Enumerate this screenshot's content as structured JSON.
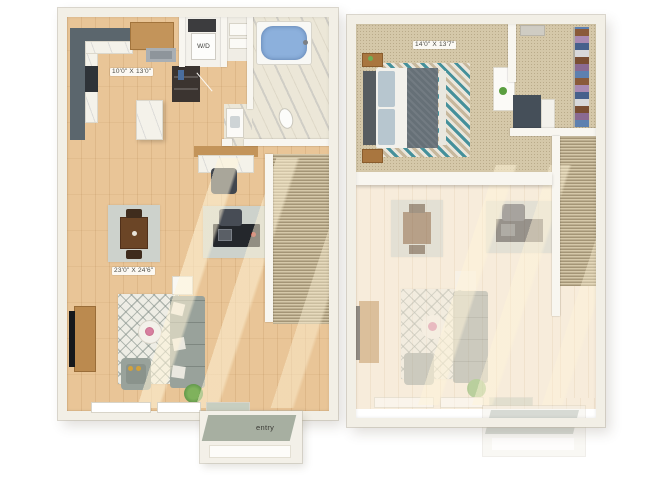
{
  "labels": {
    "floor1_kitchen_dim": "10'0\" X 13'0\"",
    "floor1_living_dim": "23'0\" X 24'6\"",
    "floor1_washer_dryer": "W/D",
    "floor1_entry": "entry",
    "floor2_bedroom_dim": "14'0\" X 13'7\""
  },
  "colors": {
    "background": "#ffffff",
    "wall": "#f2efe6",
    "kitchen_wall_dark": "#5b666d",
    "wood_floor": "#e9c597",
    "faded_wood_floor": "#f7ecdb",
    "carpet": "#d5c8a9",
    "bath_marble": "#ece7d8",
    "tub_water": "#8cb0dc",
    "sofa": "#99a29b",
    "dining_table_wood": "#6b4526",
    "cabinet_wood": "#c3945a",
    "desk_black": "#24272c",
    "chevron_rug_teal": "#45909b",
    "entry_mat": "#a7afa1",
    "plant_green": "#4f8f3a"
  }
}
